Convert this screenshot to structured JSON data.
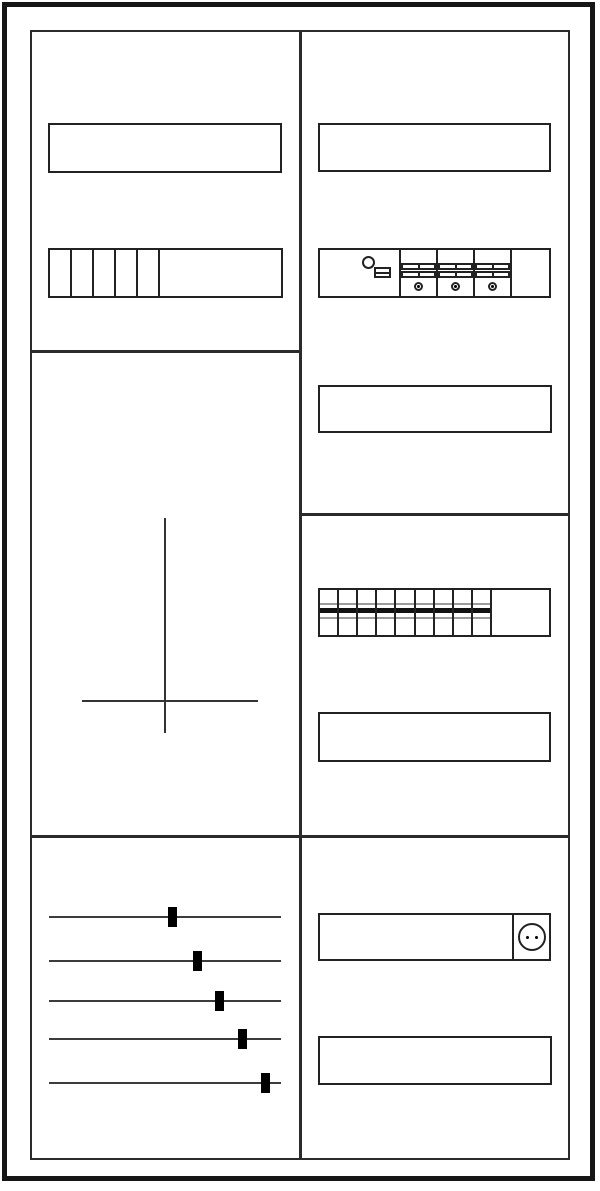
{
  "diagram": {
    "kind": "meter-cabinet-layout-drawing",
    "colors": {
      "background": "#ffffff",
      "outer_frame": "#161616",
      "panel_line": "#2b2b2b",
      "outline": "#222222",
      "rail_band_gray": "#9c9c9c",
      "rail_band_black": "#111111",
      "wire": "#3c3c3c",
      "marker": "#000000"
    },
    "left_column": {
      "label_fields": [
        {
          "text": ""
        }
      ],
      "terminal_block": {
        "segment_count": 5
      },
      "meter_cross": {
        "present": true
      },
      "wire_group": {
        "wire_count": 5,
        "wire_tops": [
          16,
          60,
          100,
          138,
          182
        ],
        "marker_fractions": [
          0.534,
          0.642,
          0.737,
          0.832,
          0.935
        ]
      }
    },
    "right_column": {
      "label_fields": [
        {
          "text": ""
        },
        {
          "text": ""
        },
        {
          "text": ""
        },
        {
          "text": ""
        }
      ],
      "switch_rail": {
        "breaker_count": 3,
        "has_control_device": true,
        "screws_per_breaker": 1
      },
      "module_rail": {
        "module_count": 9
      },
      "socket": {
        "pin_count": 2
      }
    }
  }
}
